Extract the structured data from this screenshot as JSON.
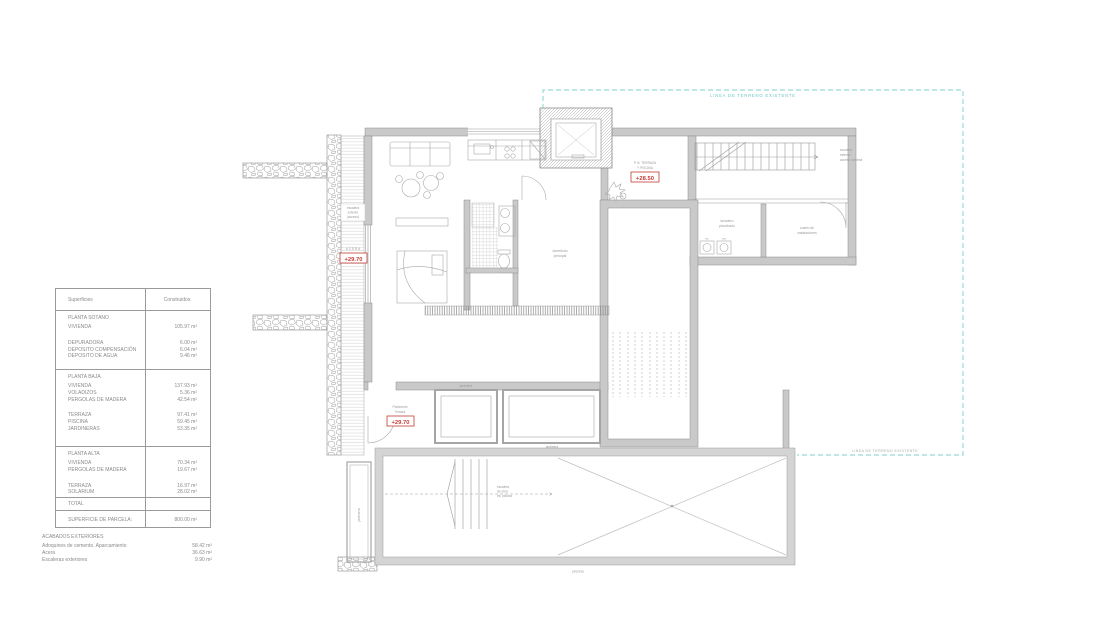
{
  "areas_table": {
    "header": {
      "col1": "Superficies",
      "col2": "Construidos"
    },
    "sections": [
      {
        "title": "PLANTA SOTANO",
        "groups": [
          [
            {
              "label": "VIVIENDA",
              "value": "105.97 m²"
            }
          ],
          [
            {
              "label": "DEPURADORA",
              "value": "6.00 m²"
            },
            {
              "label": "DEPOSITO COMPENSACIÓN",
              "value": "6.04 m²"
            },
            {
              "label": "DEPOSITO DE AGUA",
              "value": "9.46 m²"
            }
          ]
        ]
      },
      {
        "title": "PLANTA BAJA",
        "groups": [
          [
            {
              "label": "VIVIENDA",
              "value": "137.93 m²"
            },
            {
              "label": "VOLADIZOS",
              "value": "5.36 m²"
            },
            {
              "label": "PERGOLAS DE MADERA",
              "value": "42.54 m²"
            }
          ],
          [
            {
              "label": "TERRAZA",
              "value": "97.41 m²"
            },
            {
              "label": "PISCINA",
              "value": "59.45 m²"
            },
            {
              "label": "JARDINERAS",
              "value": "53.35 m²"
            }
          ]
        ]
      },
      {
        "title": "PLANTA ALTA",
        "groups": [
          [
            {
              "label": "VIVIENDA",
              "value": "70.34 m²"
            },
            {
              "label": "PERGOLAS DE MADERA",
              "value": "19.67 m²"
            }
          ],
          [
            {
              "label": "TERRAZA",
              "value": "16.97 m²"
            },
            {
              "label": "SOLARIUM",
              "value": "28.02 m²"
            }
          ]
        ]
      }
    ],
    "total_row": {
      "label": "TOTAL",
      "value": ""
    },
    "parcel_row": {
      "label": "SUPERFICIE DE PARCELA:",
      "value": "800.00 m²"
    },
    "exterior": {
      "title": "ACABADOS EXTERIORES",
      "rows": [
        {
          "label": "Adoquines de cemento. Aparcamiento",
          "value": "58.42 m²"
        },
        {
          "label": "Acera",
          "value": "36.63 m²"
        },
        {
          "label": "Escaleras exteriores",
          "value": "9.90 m²"
        }
      ]
    }
  },
  "plan": {
    "boundary": {
      "top_label": "LINEA DE TERRENO EXISTENTE",
      "right_label": "LINEA DE TERRENO EXISTENTE",
      "color": "#6cc7c7"
    },
    "levels": {
      "ramp": {
        "note": "ACERA",
        "value": "+29.70"
      },
      "terrace_center": {
        "note1": "P. B. TERRAZA",
        "note2": "Y PISCINA",
        "value": "+28.50"
      },
      "entry": {
        "note1": "Pavimento",
        "note2": "Terraza",
        "value": "+29.70"
      }
    },
    "notes": {
      "ramp_box": [
        "escalera",
        "exterior",
        "(acceso)"
      ],
      "ext_stairs": [
        "escalera",
        "exterior",
        "acceso cubierta"
      ],
      "laundry1": "lavadero",
      "laundry2": "planchado",
      "washer": "lav",
      "dryer": "sec",
      "utility1": "cuarto de",
      "utility2": "instalaciones",
      "bedroom1": "dormitorio",
      "bedroom2": "principal",
      "pool_steps": [
        "escalera",
        "de obra",
        "int. piscina"
      ],
      "pool_label": "piscina",
      "planter_top": "jardinera",
      "planter_bottom": "jardinera",
      "side_planter": "jardinera"
    },
    "colors": {
      "level_red": "#c23b32",
      "wall_fill": "#c9c9c9",
      "line": "#9a9a9a"
    }
  }
}
